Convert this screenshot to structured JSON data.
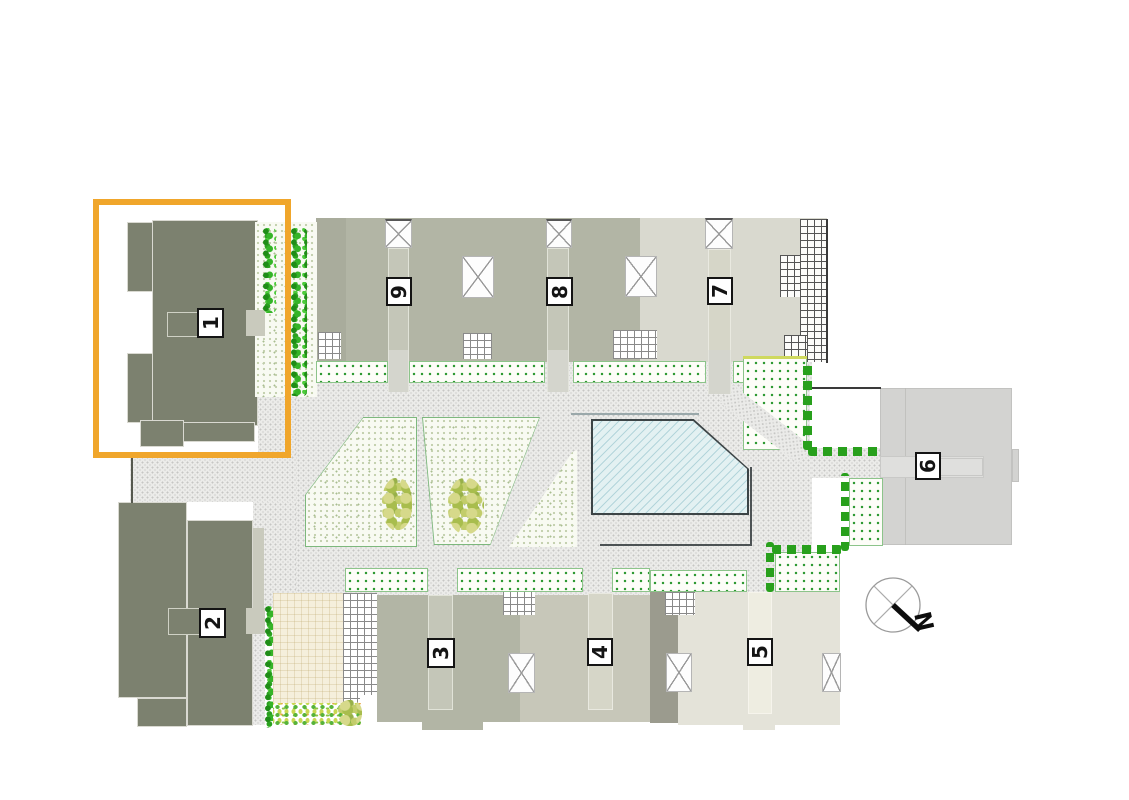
{
  "site_plan": {
    "title": "residential development site plan",
    "buildings": [
      {
        "number": "1",
        "highlighted": true
      },
      {
        "number": "2",
        "highlighted": false
      },
      {
        "number": "3",
        "highlighted": false
      },
      {
        "number": "4",
        "highlighted": false
      },
      {
        "number": "5",
        "highlighted": false
      },
      {
        "number": "6",
        "highlighted": false
      },
      {
        "number": "7",
        "highlighted": false
      },
      {
        "number": "8",
        "highlighted": false
      },
      {
        "number": "9",
        "highlighted": false
      }
    ],
    "compass": {
      "north_label": "N"
    },
    "highlight_color": "#F0A62B",
    "feature_colors": {
      "building_dark": "#7C816F",
      "building_mid": "#B2B5A5",
      "building_light": "#D9D9CF",
      "pool_water": "#E3F1F2",
      "hedge_green": "#28A01C",
      "paving_gray": "#EBEBE9"
    }
  }
}
